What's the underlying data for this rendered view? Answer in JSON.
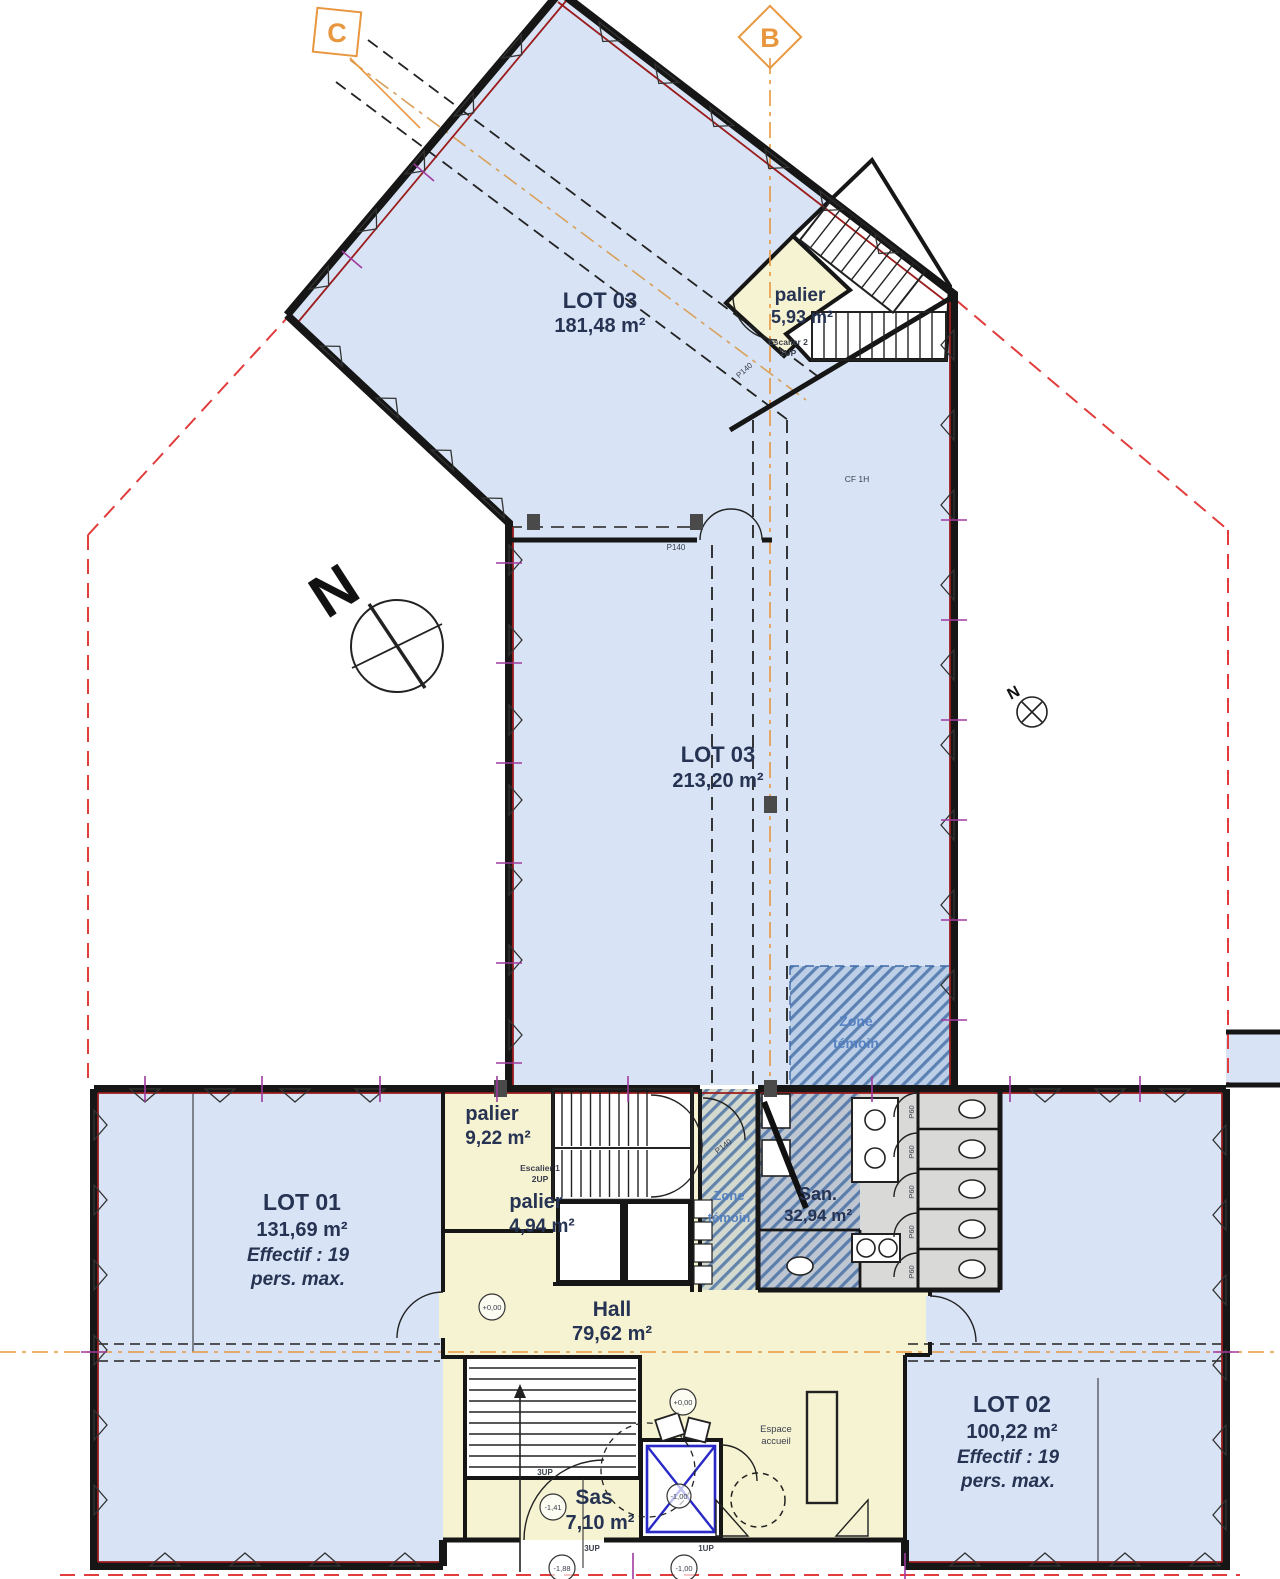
{
  "plan": {
    "section_markers": {
      "c": "C",
      "b": "B"
    },
    "north_label": "N",
    "rooms": {
      "lot03_upper": {
        "name": "LOT 03",
        "area": "181,48 m²"
      },
      "lot03_lower": {
        "name": "LOT 03",
        "area": "213,20 m²"
      },
      "lot01": {
        "name": "LOT 01",
        "area": "131,69 m²",
        "occupancy1": "Effectif : 19",
        "occupancy2": "pers. max."
      },
      "lot02": {
        "name": "LOT 02",
        "area": "100,22 m²",
        "occupancy1": "Effectif : 19",
        "occupancy2": "pers. max."
      },
      "hall": {
        "name": "Hall",
        "area": "79,62 m²"
      },
      "san": {
        "name": "San.",
        "area": "32,94 m²"
      },
      "sas": {
        "name": "Sas",
        "area": "7,10 m²"
      },
      "palier_upper": {
        "name": "palier",
        "area": "5,93 m²"
      },
      "palier_9": {
        "name": "palier",
        "area": "9,22 m²"
      },
      "palier_4": {
        "name": "palier",
        "area": "4,94 m²"
      },
      "espace_accueil": {
        "line1": "Espace",
        "line2": "accueil"
      },
      "zone_temoin": {
        "line1": "Zone",
        "line2": "témoin"
      }
    },
    "stairs": {
      "escalier1": {
        "name": "Escalier 1",
        "rise": "2UP"
      },
      "escalier2": {
        "name": "Escalier 2",
        "rise": "2UP"
      },
      "entry_stair_rise": "3UP",
      "entry_step_rise": "1UP"
    },
    "doors": {
      "p140": "P140",
      "p60": "P60"
    },
    "fire_rating": "CF 1H",
    "levels": {
      "hall": "+0,00",
      "accueil": "+0,00",
      "sas": "-1,41",
      "lift": "-1,00",
      "outside_left": "-1,88",
      "outside_right": "-1,00"
    },
    "colors": {
      "floor_blue": "#d8e4f5",
      "floor_yellow": "#f6f3d2",
      "floor_grey": "#d9d9d7",
      "wall": "#161616",
      "axis_orange": "#e8973f",
      "boundary_red": "#e23c3c",
      "tick_magenta": "#a03aa0",
      "hatch_blue": "#4d7cc0",
      "label_navy": "#263352"
    }
  }
}
